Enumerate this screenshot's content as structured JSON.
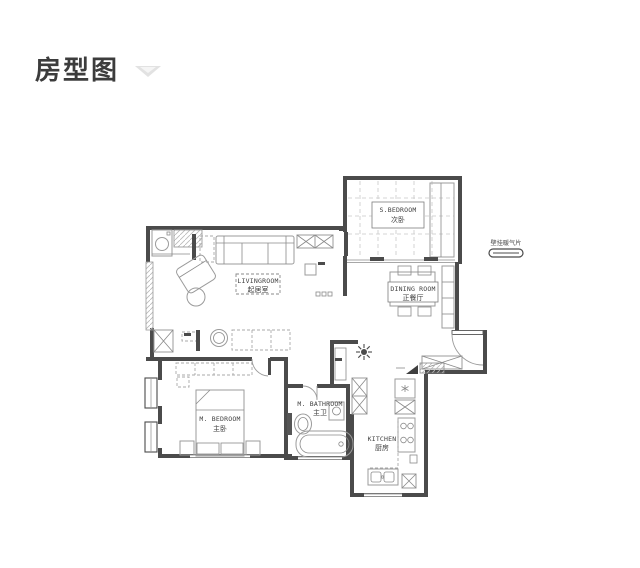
{
  "header": {
    "title": "房型图"
  },
  "plan": {
    "rooms": {
      "living": {
        "en": "LIVINGROOM",
        "zh": "起居室"
      },
      "secondBedroom": {
        "en": "S.BEDROOM",
        "zh": "次卧"
      },
      "dining": {
        "en": "DINING ROOM",
        "zh": "正餐厅"
      },
      "masterBedroom": {
        "en": "M. BEDROOM",
        "zh": "主卧"
      },
      "masterBath": {
        "en": "M. BATHROOM",
        "zh": "主卫"
      },
      "kitchen": {
        "en": "KITCHEN",
        "zh": "厨房"
      }
    },
    "annotations": {
      "radiator": "壁挂暖气片"
    },
    "colors": {
      "wall": "#4b4b4b",
      "furniture": "#9b9b9b",
      "chevron": "#dedede"
    }
  }
}
